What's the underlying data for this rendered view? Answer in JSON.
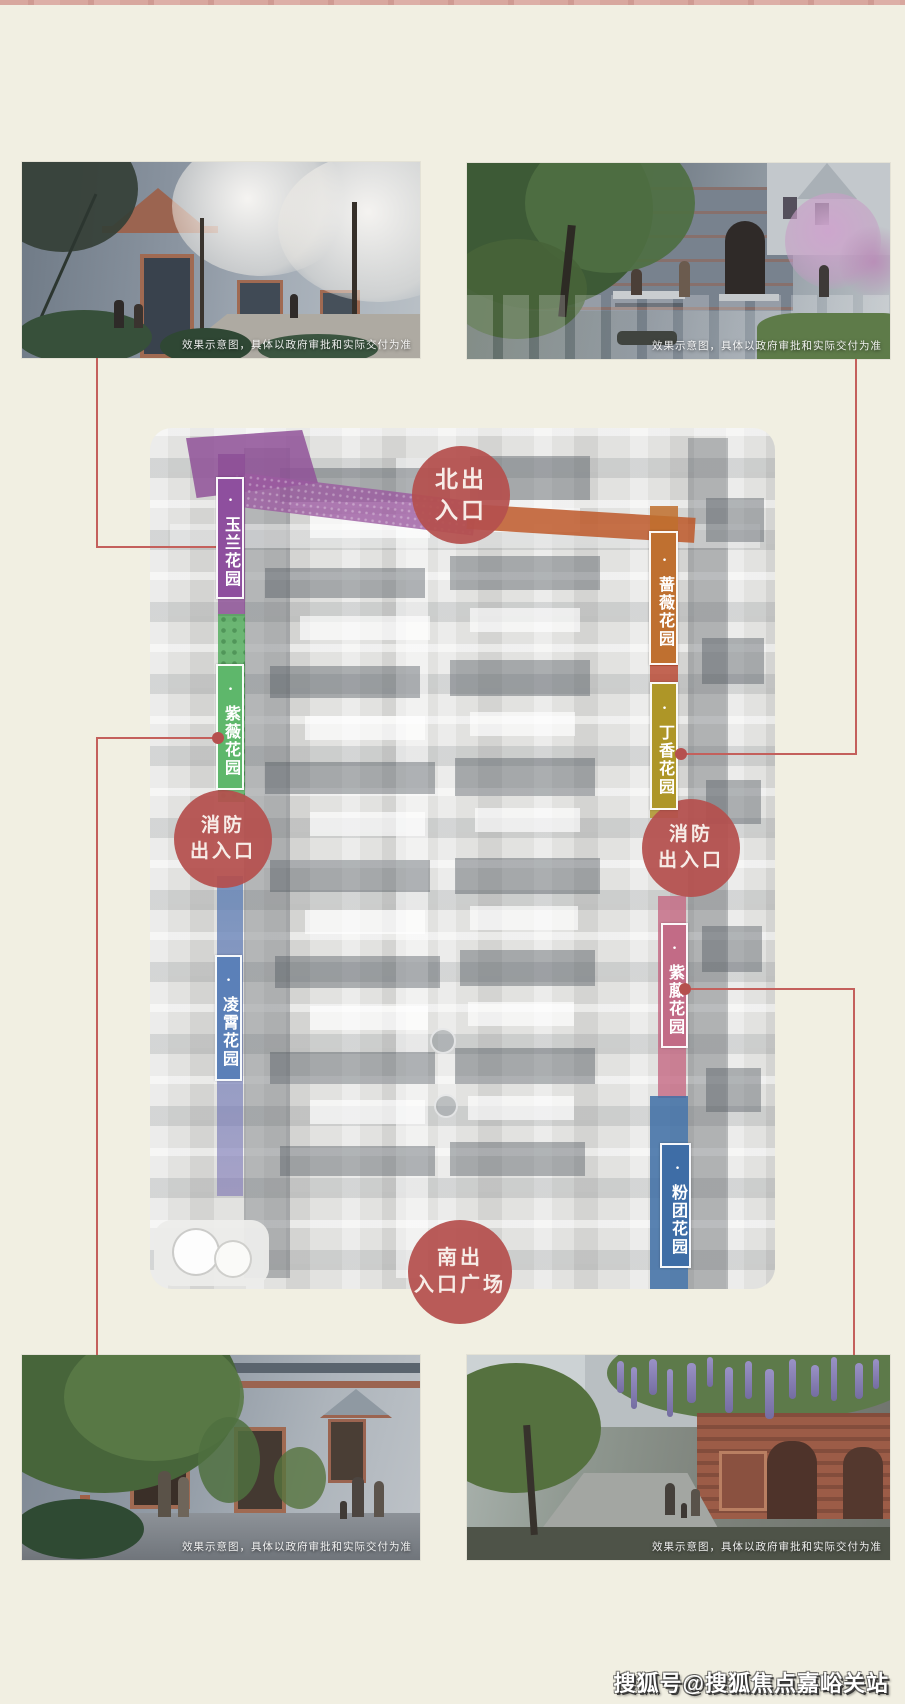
{
  "page": {
    "background_color": "#f1efe2",
    "top_strip_color": "#d8a79e",
    "watermark": "搜狐号@搜狐焦点嘉峪关站"
  },
  "photos": {
    "caption": "效果示意图，具体以政府审批和实际交付为准"
  },
  "map": {
    "accent_red": "#b5504e",
    "connector_color": "#c4605c",
    "bullet": "·",
    "entrances": {
      "north": {
        "line1": "北出",
        "line2": "入口"
      },
      "fire": {
        "line1": "消防",
        "line2": "出入口"
      },
      "south": {
        "line1": "南出",
        "line2": "入口广场"
      }
    },
    "gardens": [
      {
        "name": "玉兰花园",
        "color": "#8e4f9e"
      },
      {
        "name": "紫薇花园",
        "color": "#5eb76b"
      },
      {
        "name": "凌霄花园",
        "color": "#5b80b8"
      },
      {
        "name": "蔷薇花园",
        "color": "#bf7030"
      },
      {
        "name": "丁香花园",
        "color": "#ae9627"
      },
      {
        "name": "紫藤花园",
        "color": "#c26b86"
      },
      {
        "name": "粉团花园",
        "color": "#3e6da6"
      }
    ]
  }
}
